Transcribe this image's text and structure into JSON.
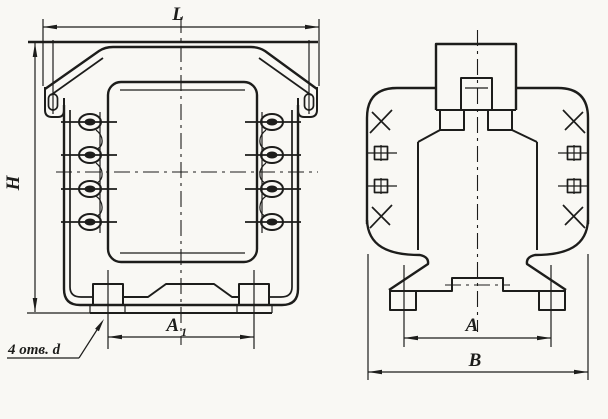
{
  "drawing": {
    "colors": {
      "background": "#f9f8f4",
      "ink": "#1d1d1b"
    },
    "labels": {
      "length": "L",
      "height": "H",
      "front_mount_span": "A",
      "front_mount_span_sub": "1",
      "side_mount_span": "A",
      "overall_width": "B",
      "holes_note": "4 отв. d"
    }
  }
}
